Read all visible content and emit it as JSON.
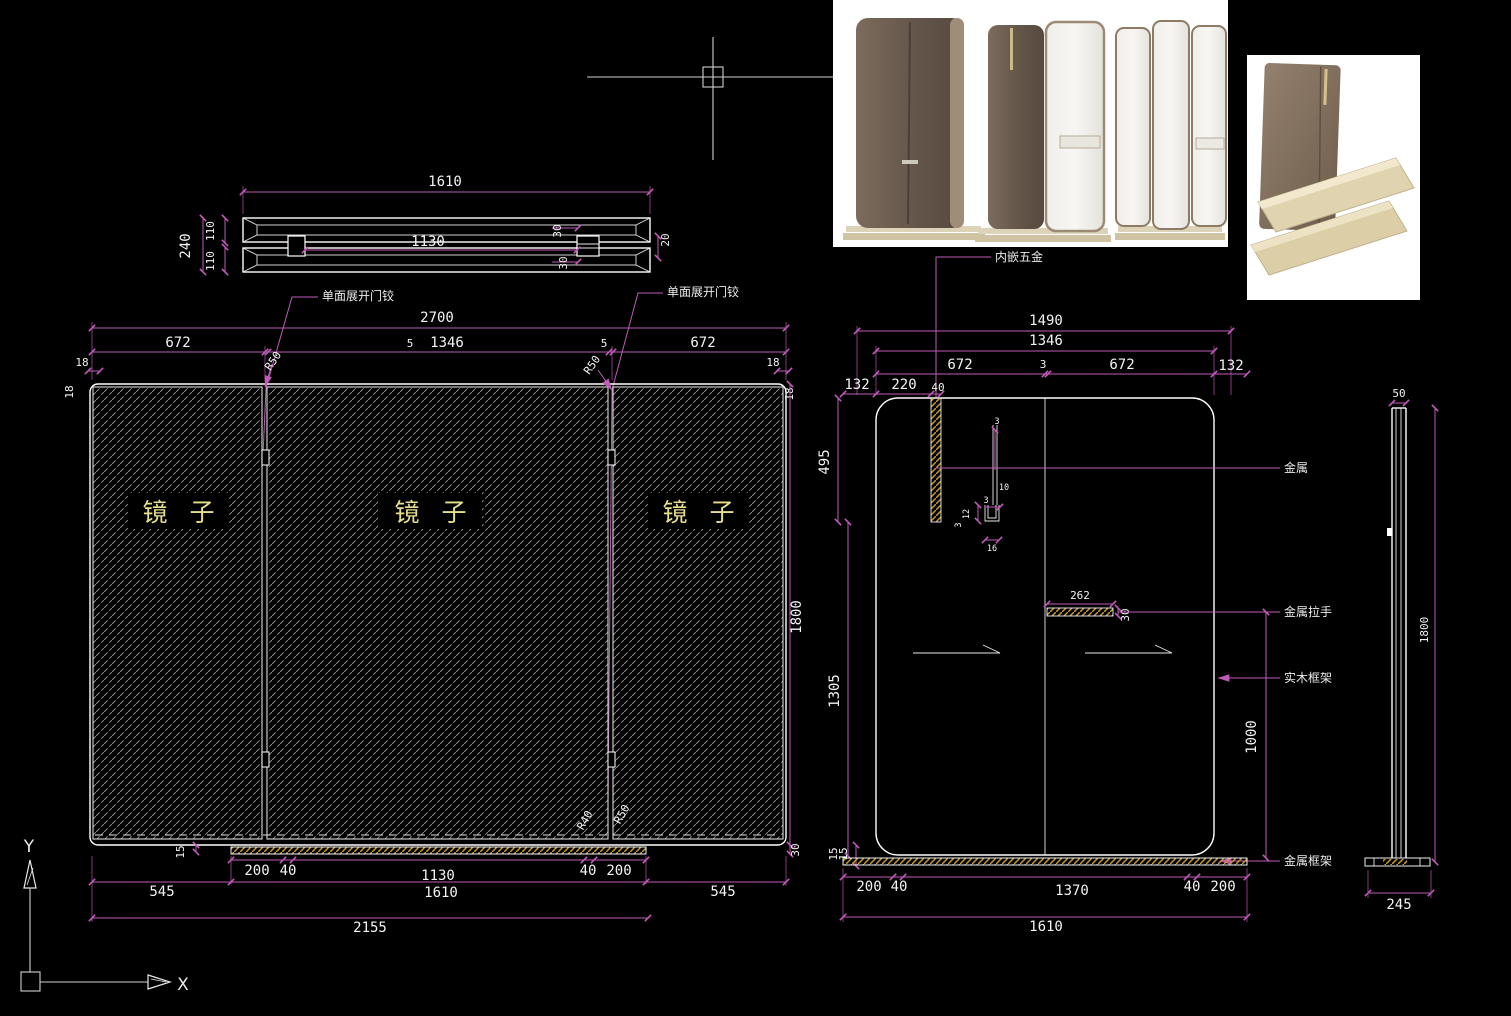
{
  "colors": {
    "background": "#000000",
    "geometry": "#ffffff",
    "dimension": "#c05ab8",
    "gold_hatch": "#c79a2e",
    "gray_hatch": "#9a9a9a",
    "mirror_text": "#e6df8e"
  },
  "section_view": {
    "total_width": "1610",
    "inner_width": "1130",
    "height": "240",
    "upper": "110",
    "lower": "110",
    "stub_top": "30",
    "stub_bottom": "30",
    "offset": "20"
  },
  "front_view": {
    "hinge_left": "单面展开门铰",
    "hinge_right": "单面展开门铰",
    "total": "2700",
    "panel_left": "672",
    "gap_left": "5",
    "panel_center": "1346",
    "gap_right": "5",
    "panel_right": "672",
    "edge_tl": "18",
    "edge_tl_side": "18",
    "edge_tr": "18",
    "edge_tr_side": "18",
    "radius_tl": "R50",
    "radius_tr": "R50",
    "radius_b1": "R40",
    "radius_b2": "R50",
    "height": "1800",
    "base_h": "30",
    "base_lip": "15",
    "b200l": "200",
    "b40l": "40",
    "b1130": "1130",
    "b40r": "40",
    "b200r": "200",
    "b545l": "545",
    "b1610": "1610",
    "b545r": "545",
    "b2155": "2155",
    "mirror_1": "镜 子",
    "mirror_2": "镜 子",
    "mirror_3": "镜 子"
  },
  "detail_view": {
    "hardware": "内嵌五金",
    "w1490": "1490",
    "w1346": "1346",
    "p672l": "672",
    "gap3": "3",
    "p672r": "672",
    "m132l": "132",
    "m132r": "132",
    "m220": "220",
    "m40": "40",
    "v495": "495",
    "v1305": "1305",
    "v15a": "15",
    "v15b": "15",
    "u3a": "3",
    "u10": "10",
    "u3b": "3",
    "u12": "12",
    "u3c": "3",
    "u16": "16",
    "handle_len": "262",
    "handle_h": "30",
    "metal": "金属",
    "metal_handle": "金属拉手",
    "wood_frame": "实木框架",
    "metal_frame": "金属框架",
    "v1000": "1000",
    "b200l": "200",
    "b40l": "40",
    "b1370": "1370",
    "b40r": "40",
    "b200r": "200",
    "b1610": "1610"
  },
  "side_view": {
    "w50": "50",
    "h1800": "1800",
    "b245": "245"
  },
  "ucs": {
    "x": "X",
    "y": "Y"
  }
}
